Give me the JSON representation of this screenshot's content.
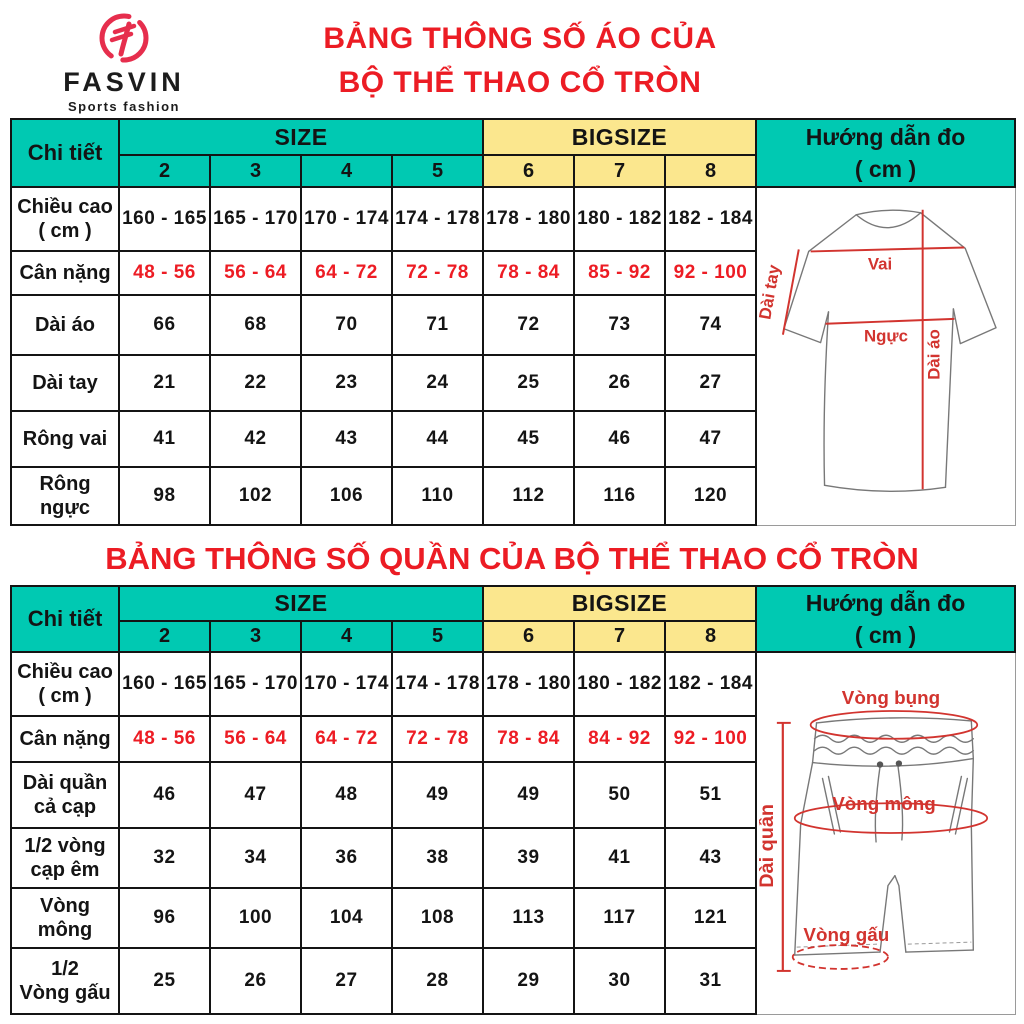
{
  "brand": {
    "name": "FASVIN",
    "tagline": "Sports fashion"
  },
  "titles": {
    "shirt_line1": "BẢNG THÔNG SỐ ÁO CỦA",
    "shirt_line2": "BỘ THỂ THAO CỔ TRÒN",
    "pants": "BẢNG THÔNG SỐ QUẦN CỦA BỘ THỂ THAO CỔ TRÒN"
  },
  "colors": {
    "teal": "#00C9B2",
    "yellow": "#FBE78E",
    "title_red": "#EC1C24",
    "value_red": "#ED1C24",
    "diagram_red": "#D2342F"
  },
  "table_header": {
    "detail": "Chi tiết",
    "size": "SIZE",
    "bigsize": "BIGSIZE",
    "guide": "Hướng dẫn đo\n( cm )",
    "sizes": [
      "2",
      "3",
      "4",
      "5"
    ],
    "bigsizes": [
      "6",
      "7",
      "8"
    ]
  },
  "shirt": {
    "rows": [
      {
        "label": "Chiều cao\n( cm )",
        "values": [
          "160 - 165",
          "165 - 170",
          "170 - 174",
          "174 - 178",
          "178 - 180",
          "180 - 182",
          "182 - 184"
        ]
      },
      {
        "label": "Cân nặng",
        "values": [
          "48 - 56",
          "56 - 64",
          "64 - 72",
          "72 - 78",
          "78 - 84",
          "85 - 92",
          "92 - 100"
        ]
      },
      {
        "label": "Dài áo",
        "values": [
          "66",
          "68",
          "70",
          "71",
          "72",
          "73",
          "74"
        ]
      },
      {
        "label": "Dài tay",
        "values": [
          "21",
          "22",
          "23",
          "24",
          "25",
          "26",
          "27"
        ]
      },
      {
        "label": "Rông vai",
        "values": [
          "41",
          "42",
          "43",
          "44",
          "45",
          "46",
          "47"
        ]
      },
      {
        "label": "Rông ngực",
        "values": [
          "98",
          "102",
          "106",
          "110",
          "112",
          "116",
          "120"
        ]
      }
    ]
  },
  "pants": {
    "rows": [
      {
        "label": "Chiều cao\n( cm )",
        "values": [
          "160 - 165",
          "165 - 170",
          "170 - 174",
          "174 - 178",
          "178 - 180",
          "180 - 182",
          "182 - 184"
        ]
      },
      {
        "label": "Cân nặng",
        "values": [
          "48 - 56",
          "56 - 64",
          "64 - 72",
          "72 - 78",
          "78 - 84",
          "84 - 92",
          "92 - 100"
        ]
      },
      {
        "label": "Dài quần\ncả cạp",
        "values": [
          "46",
          "47",
          "48",
          "49",
          "49",
          "50",
          "51"
        ]
      },
      {
        "label": "1/2 vòng\ncạp êm",
        "values": [
          "32",
          "34",
          "36",
          "38",
          "39",
          "41",
          "43"
        ]
      },
      {
        "label": "Vòng\nmông",
        "values": [
          "96",
          "100",
          "104",
          "108",
          "113",
          "117",
          "121"
        ]
      },
      {
        "label": "1/2\nVòng gấu",
        "values": [
          "25",
          "26",
          "27",
          "28",
          "29",
          "30",
          "31"
        ]
      }
    ]
  },
  "shirt_diagram": {
    "vai": "Vai",
    "nguc": "Ngực",
    "dai_tay": "Dài tay",
    "dai_ao": "Dài áo"
  },
  "pants_diagram": {
    "vong_bung": "Vòng bụng",
    "vong_mong": "Vòng mông",
    "dai_quan": "Dài quần",
    "vong_gau": "Vòng gấu"
  }
}
